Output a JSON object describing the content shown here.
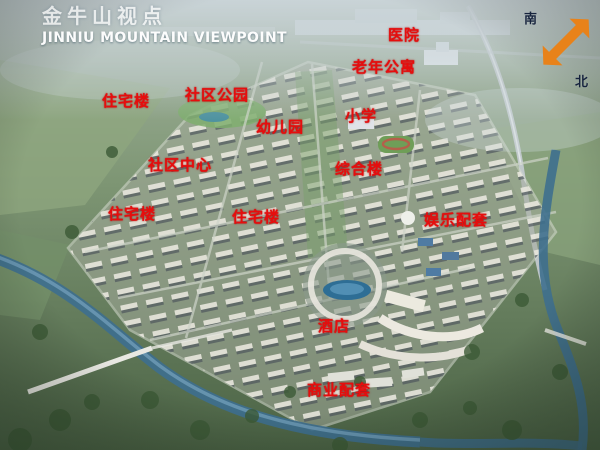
{
  "title": {
    "cn": "金牛山视点",
    "en": "JINNIU MOUNTAIN VIEWPOINT"
  },
  "compass": {
    "south": "南",
    "north": "北",
    "arrow_color": "#e8821a"
  },
  "labels": [
    {
      "id": "hospital",
      "text": "医院"
    },
    {
      "id": "senior-apartments",
      "text": "老年公寓"
    },
    {
      "id": "residential-1",
      "text": "住宅楼"
    },
    {
      "id": "community-park",
      "text": "社区公园"
    },
    {
      "id": "kindergarten",
      "text": "幼儿园"
    },
    {
      "id": "primary-school",
      "text": "小学"
    },
    {
      "id": "community-center",
      "text": "社区中心"
    },
    {
      "id": "complex-building",
      "text": "综合楼"
    },
    {
      "id": "residential-2",
      "text": "住宅楼"
    },
    {
      "id": "residential-3",
      "text": "住宅楼"
    },
    {
      "id": "entertainment-zone",
      "text": "娱乐配套"
    },
    {
      "id": "hotel",
      "text": "酒店"
    },
    {
      "id": "commercial-zone",
      "text": "商业配套"
    }
  ],
  "colors": {
    "label_red": "#e70d0d",
    "title_white": "#ffffff",
    "compass_orange": "#e8821a",
    "water_blue": "#3e6f8e"
  }
}
